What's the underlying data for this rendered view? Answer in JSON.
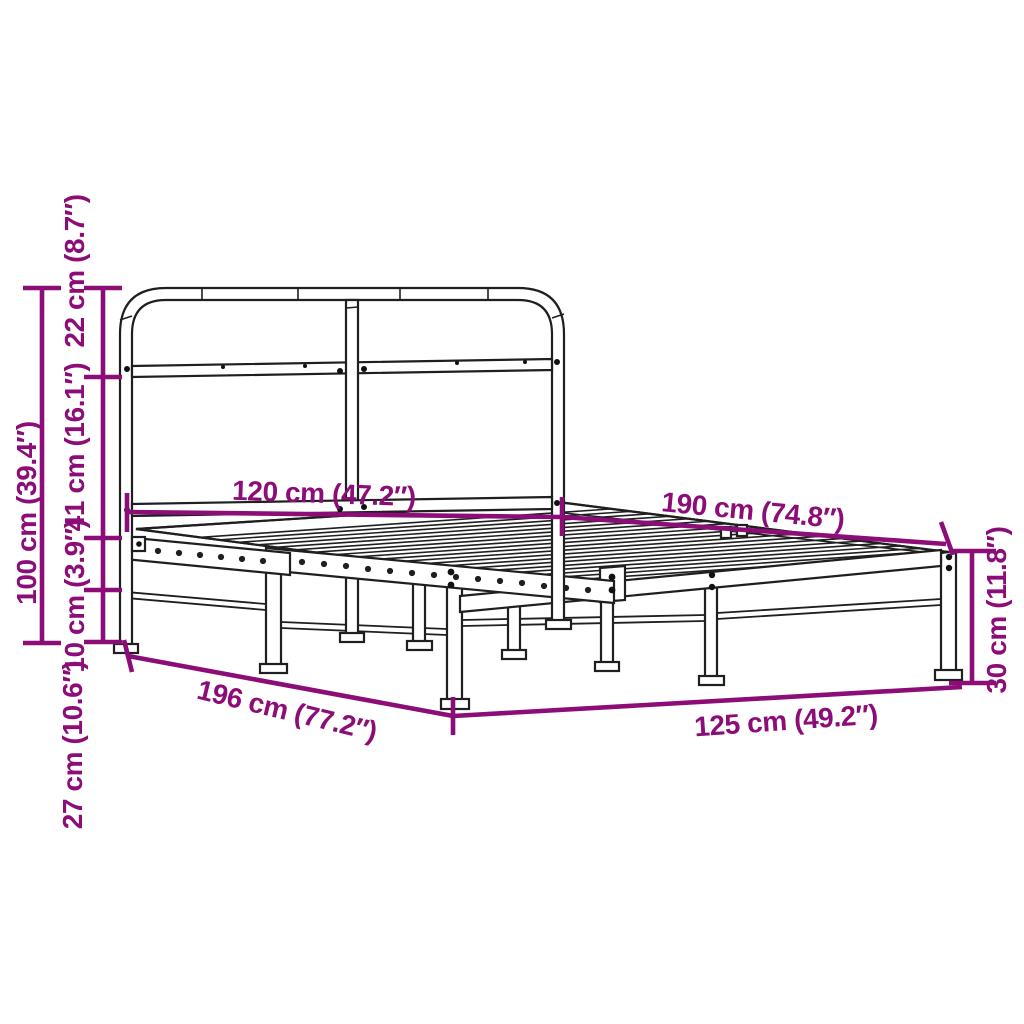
{
  "colors": {
    "dimension_annotations": "#8C0D78",
    "line_art": "#1F1F1F",
    "background": "#FFFFFF"
  },
  "dims": {
    "total_height": "100 cm (39.4″)",
    "headboard_top_section": "22 cm (8.7″)",
    "headboard_middle_section": "41 cm (16.1″)",
    "side_rail_height": "10 cm (3.9″)",
    "under_bed_clearance": "27 cm (10.6″)",
    "mattress_width": "120 cm (47.2″)",
    "mattress_length": "190 cm (74.8″)",
    "frame_length": "196 cm (77.2″)",
    "frame_width": "125 cm (49.2″)",
    "foot_end_height": "30 cm (11.8″)"
  }
}
